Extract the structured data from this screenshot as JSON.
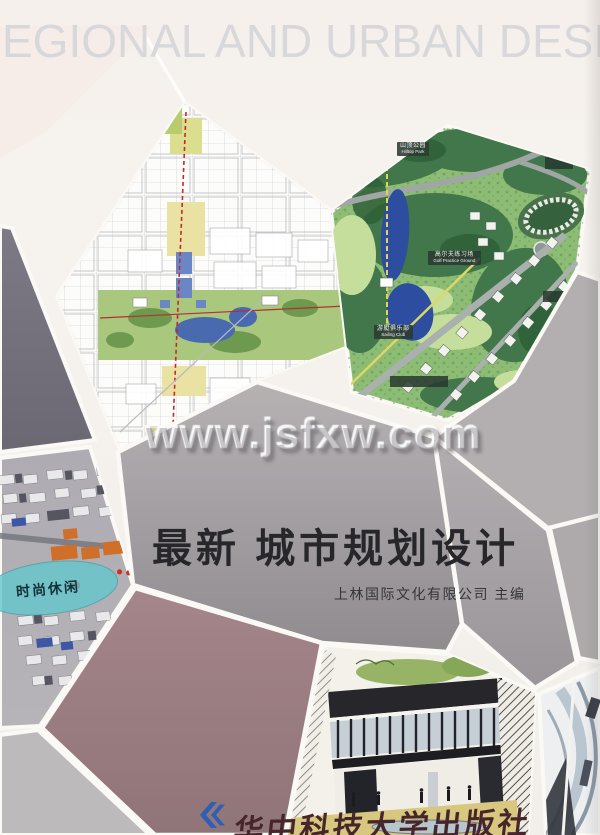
{
  "header": {
    "text": "EGIONAL AND URBAN DESIGN"
  },
  "watermark": {
    "text": "www.jsfxw.com"
  },
  "cover": {
    "title": "最新 城市规划设计",
    "editor_line": "上林国际文化有限公司 主编",
    "publisher": "华中科技大学出版社"
  },
  "park_labels": [
    {
      "cn": "山顶公园",
      "en": "Hilltop Park"
    },
    {
      "cn": "高尔夫练习场",
      "en": "Golf Practice Ground"
    },
    {
      "cn": "游艇俱乐部",
      "en": "Sailing Club"
    }
  ],
  "render_label": {
    "text": "时尚休闲"
  },
  "colors": {
    "leisure_cyan": "#5fc6cb",
    "publisher_blue": "#2e5fb7",
    "title_ink": "#26262b",
    "mauve_tile": "#9d7f82",
    "slate_tile": "#73707d",
    "watermark_gray": "#8e8a8e"
  }
}
